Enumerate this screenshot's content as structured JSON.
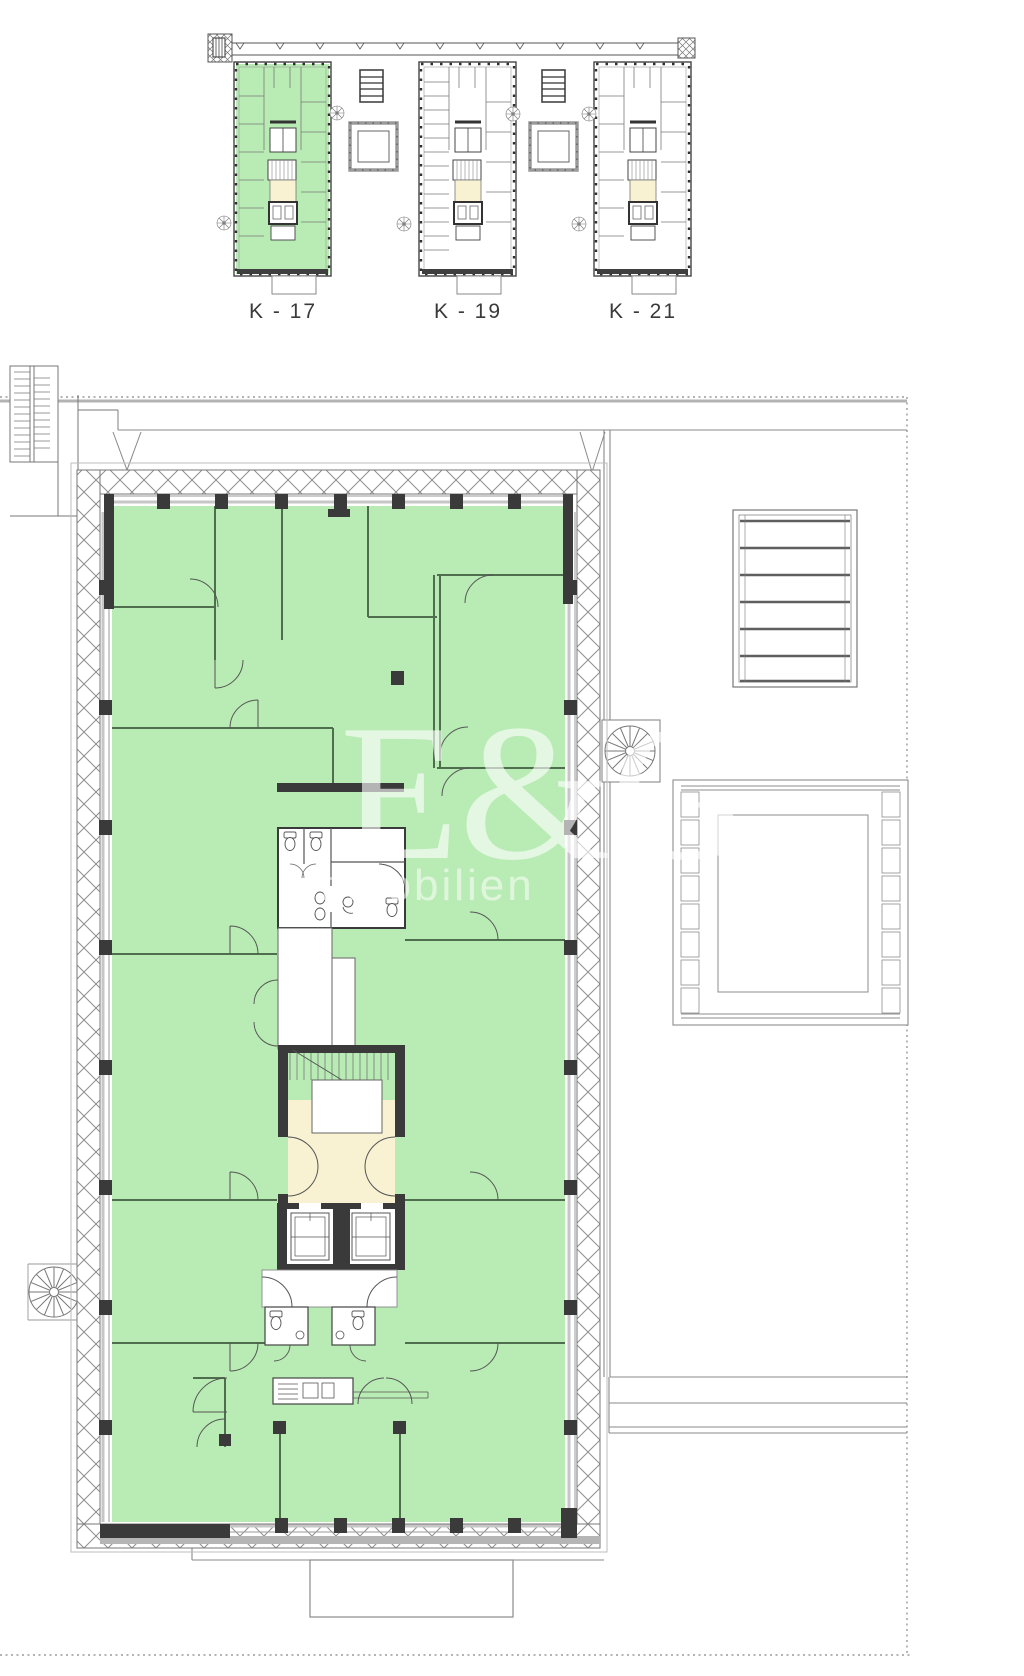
{
  "document": {
    "type": "architectural-floor-plan",
    "page_background": "#ffffff"
  },
  "overview": {
    "wings": [
      {
        "label": "K - 17",
        "highlighted": true
      },
      {
        "label": "K - 19",
        "highlighted": false
      },
      {
        "label": "K - 21",
        "highlighted": false
      }
    ]
  },
  "main_plan": {
    "stairwell": {
      "label_line1": "20 STG",
      "label_line2": "17.5/27.0"
    }
  },
  "watermark": {
    "line1": "E&G",
    "line2": "Immobilien"
  },
  "colors": {
    "highlight_green": "#b9ecb4",
    "lobby_cream": "#f8f2d3",
    "wall_dark": "#3a3a3a",
    "line_gray": "#8a8a8a"
  }
}
